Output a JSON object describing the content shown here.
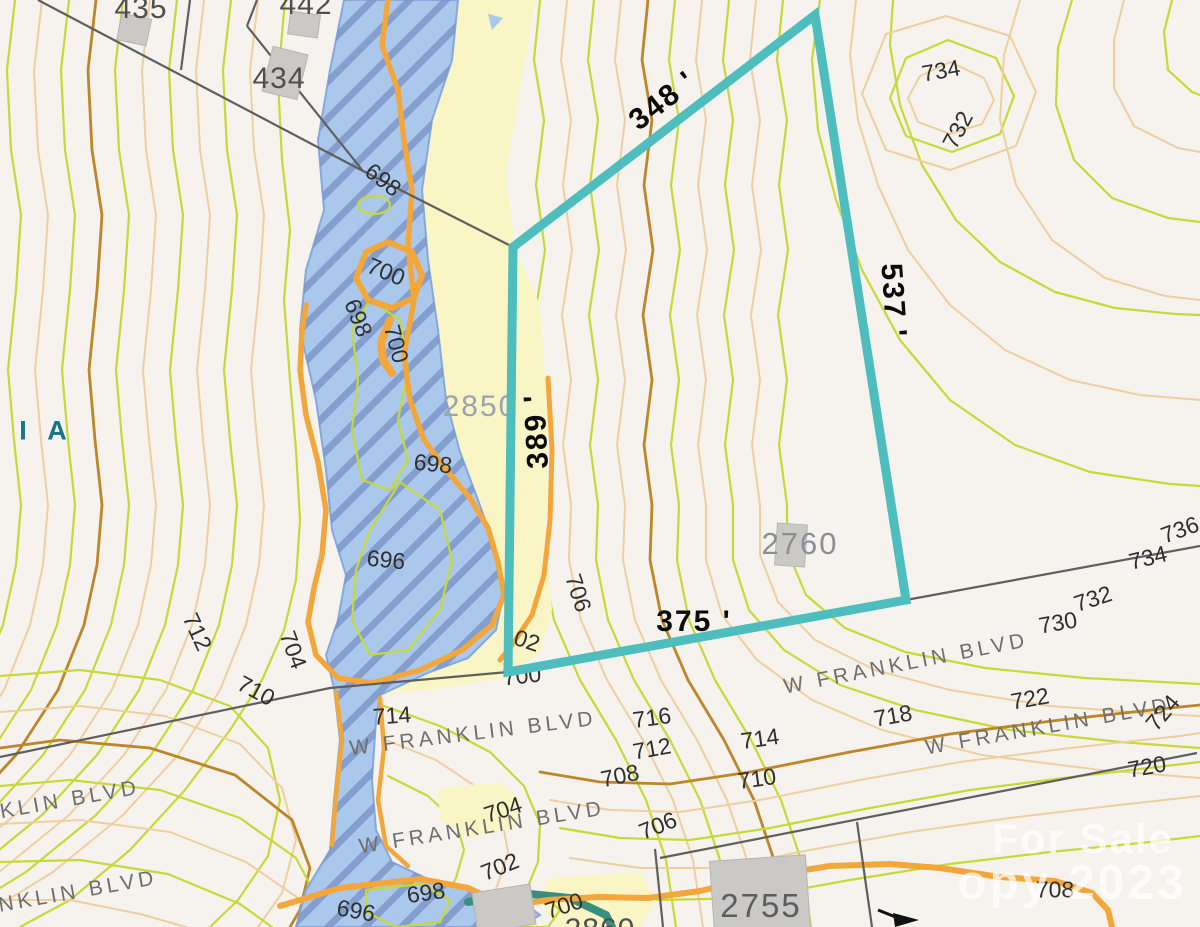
{
  "map": {
    "region_label": "I I A",
    "boundary": {
      "color": "#4dbdbe",
      "side_lengths": {
        "top": "348 '",
        "right": "537 '",
        "left": "389 '",
        "bottom": "375 '"
      }
    },
    "parcel_numbers": {
      "p435": "435",
      "p442": "442",
      "p434": "434",
      "p2850": "2850",
      "p2760": "2760",
      "p2755": "2755",
      "p2860": "2860"
    },
    "street_labels": {
      "s1": "W FRANKLIN BLVD",
      "s2": "W FRANKLIN BLVD",
      "s3": "KLIN BLVD",
      "s4": "NKLIN BLVD",
      "s5": "W FRANKLIN BLVD",
      "s6": "W FRANKLIN BLVD"
    },
    "contour_labels": [
      {
        "text": "698"
      },
      {
        "text": "700"
      },
      {
        "text": "698"
      },
      {
        "text": "700"
      },
      {
        "text": "698"
      },
      {
        "text": "696"
      },
      {
        "text": "712"
      },
      {
        "text": "704"
      },
      {
        "text": "710"
      },
      {
        "text": "714"
      },
      {
        "text": "02"
      },
      {
        "text": "700"
      },
      {
        "text": "706"
      },
      {
        "text": "716"
      },
      {
        "text": "712"
      },
      {
        "text": "708"
      },
      {
        "text": "714"
      },
      {
        "text": "710"
      },
      {
        "text": "704"
      },
      {
        "text": "706"
      },
      {
        "text": "702"
      },
      {
        "text": "698"
      },
      {
        "text": "696"
      },
      {
        "text": "700"
      },
      {
        "text": "734"
      },
      {
        "text": "732"
      },
      {
        "text": "736"
      },
      {
        "text": "734"
      },
      {
        "text": "732"
      },
      {
        "text": "730"
      },
      {
        "text": "722"
      },
      {
        "text": "718"
      },
      {
        "text": "724"
      },
      {
        "text": "720"
      },
      {
        "text": "708"
      }
    ],
    "watermark": {
      "line1": "For Sale",
      "line2": "opy 2023"
    },
    "legend_colors": {
      "floodway_fill": "#a9c8ec",
      "flood_fringe_fill": "#f9f5c5",
      "contour_minor_green": "#c6d937",
      "contour_minor_tan": "#eecf9f",
      "contour_index_brown": "#bd8629",
      "contour_index_orange": "#f3a63a",
      "parcel_line": "#5f5f5f",
      "building_fill": "#cbc9c5"
    }
  }
}
